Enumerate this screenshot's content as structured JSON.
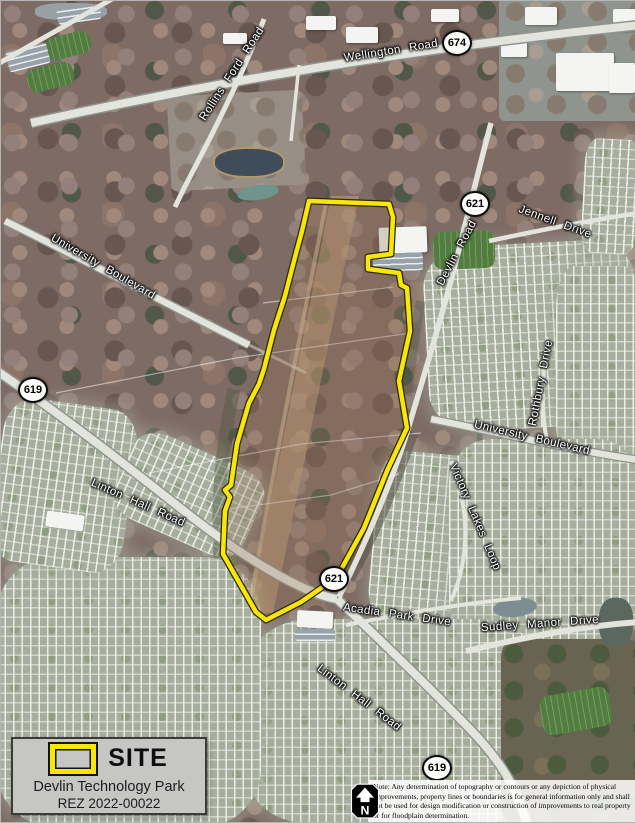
{
  "legend": {
    "site_label": "SITE",
    "project_name": "Devlin Technology Park",
    "case_number": "REZ 2022-00022"
  },
  "disclaimer": {
    "text": "Note: Any determination of topography or contours or any depiction of physical improvements, property lines or boundaries is for general information only and shall not be used for design modification or construction of improvements to real property or for floodplain determination."
  },
  "north_arrow": {
    "letter": "N"
  },
  "map": {
    "type": "aerial-imagery",
    "site_boundary_color": "#f7e50c",
    "road_labels": [
      {
        "text": "Wellington Road",
        "x": 390,
        "y": 50,
        "rot": -9
      },
      {
        "text": "Rollins Ford Road",
        "x": 231,
        "y": 73,
        "rot": -57
      },
      {
        "text": "University Boulevard",
        "x": 102,
        "y": 266,
        "rot": 30
      },
      {
        "text": "Jennell Drive",
        "x": 554,
        "y": 221,
        "rot": 20
      },
      {
        "text": "Devlin Road",
        "x": 456,
        "y": 252,
        "rot": -62
      },
      {
        "text": "Rothbury Drive",
        "x": 540,
        "y": 382,
        "rot": -79
      },
      {
        "text": "University Boulevard",
        "x": 531,
        "y": 437,
        "rot": 13
      },
      {
        "text": "Victory Lakes Loop",
        "x": 474,
        "y": 516,
        "rot": 67
      },
      {
        "text": "Linton Hall Road",
        "x": 137,
        "y": 502,
        "rot": 24
      },
      {
        "text": "Acadia Park Drive",
        "x": 396,
        "y": 614,
        "rot": 8
      },
      {
        "text": "Sudley Manor Drive",
        "x": 539,
        "y": 623,
        "rot": -4
      },
      {
        "text": "Linton Hall Road",
        "x": 358,
        "y": 697,
        "rot": 37
      }
    ],
    "route_shields": [
      {
        "number": "674",
        "x": 456,
        "y": 42
      },
      {
        "number": "621",
        "x": 474,
        "y": 203
      },
      {
        "number": "619",
        "x": 32,
        "y": 389
      },
      {
        "number": "621",
        "x": 333,
        "y": 578
      },
      {
        "number": "619",
        "x": 436,
        "y": 767
      }
    ]
  }
}
